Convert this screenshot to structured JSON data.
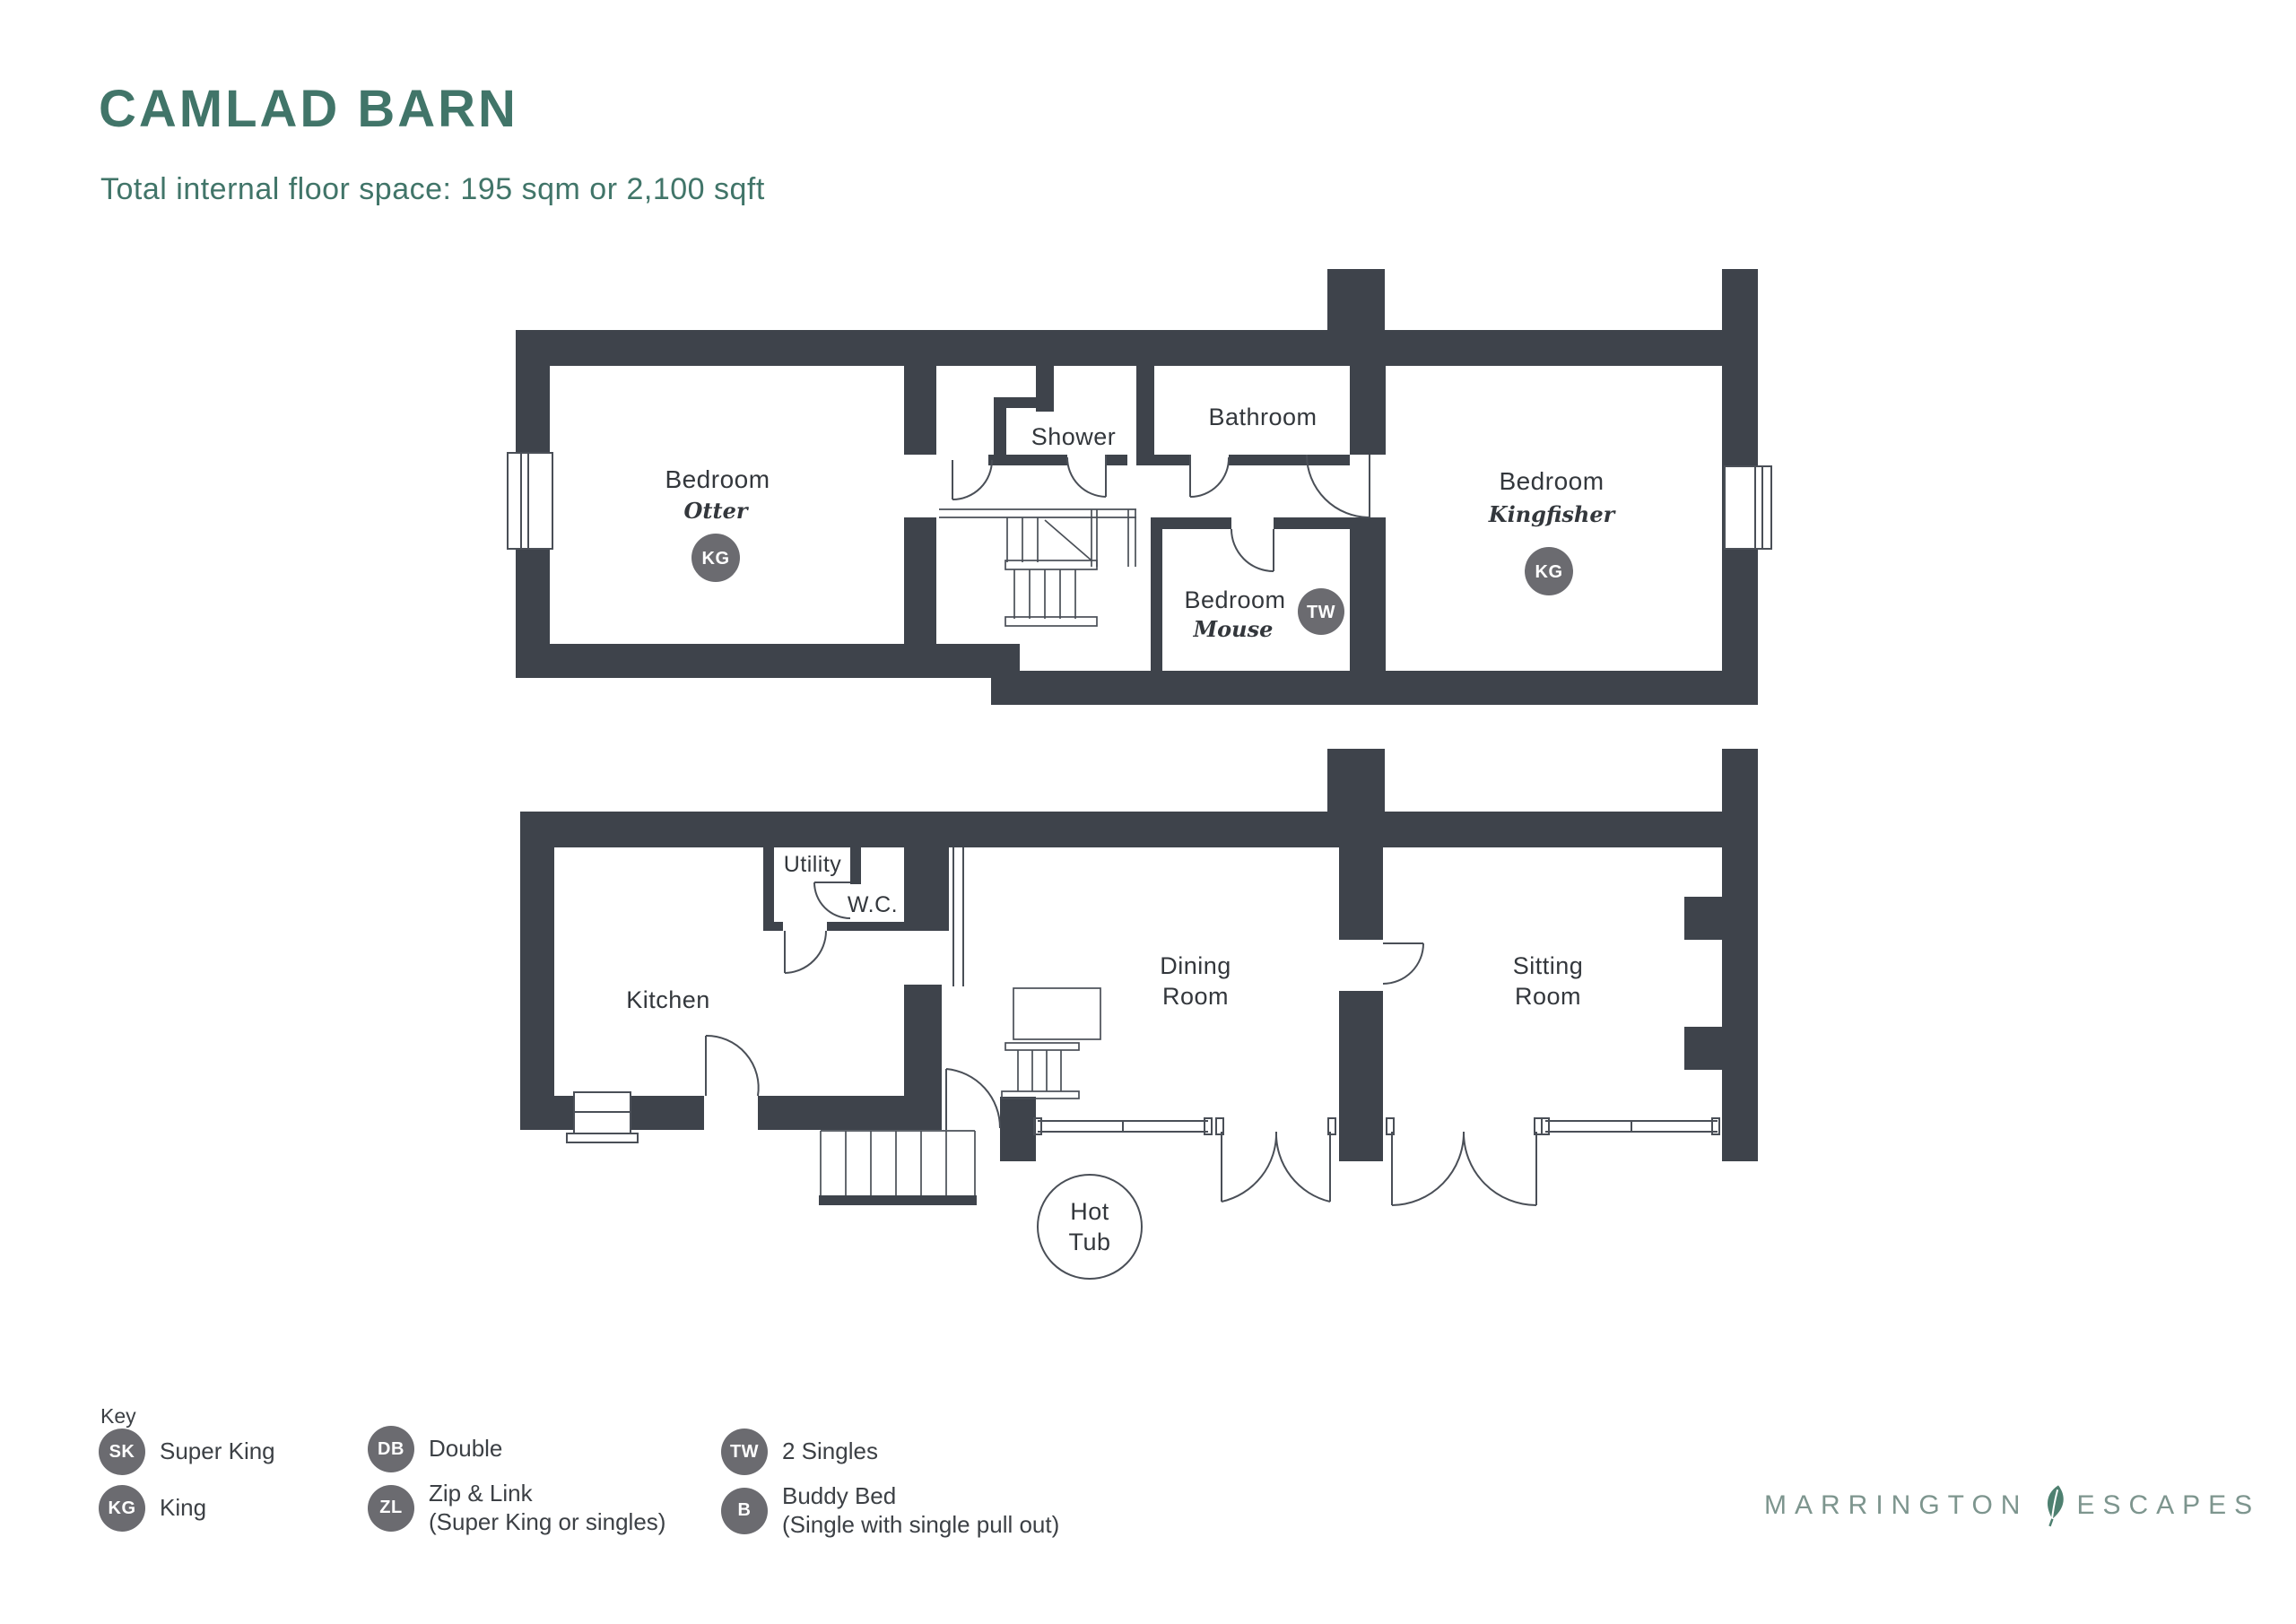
{
  "page": {
    "title": "CAMLAD BARN",
    "subtitle": "Total internal floor space: 195 sqm or 2,100 sqft"
  },
  "colors": {
    "accent": "#417569",
    "wall": "#3e434b",
    "thin_line": "#4a4f57",
    "badge": "#6b6b70",
    "label_text": "#33373c",
    "logo_text": "#7d958e",
    "leaf": "#4e8070"
  },
  "first_floor": {
    "bedroom_otter": {
      "label": "Bedroom",
      "name": "Otter",
      "badge": "KG"
    },
    "shower": {
      "label": "Shower"
    },
    "bathroom": {
      "label": "Bathroom"
    },
    "bedroom_mouse": {
      "label": "Bedroom",
      "name": "Mouse",
      "badge": "TW"
    },
    "bedroom_kingfisher": {
      "label": "Bedroom",
      "name": "Kingfisher",
      "badge": "KG"
    }
  },
  "ground_floor": {
    "kitchen": {
      "label": "Kitchen"
    },
    "utility": {
      "label": "Utility"
    },
    "wc": {
      "label": "W.C."
    },
    "dining": {
      "line1": "Dining",
      "line2": "Room"
    },
    "sitting": {
      "line1": "Sitting",
      "line2": "Room"
    },
    "hot_tub": {
      "line1": "Hot",
      "line2": "Tub"
    }
  },
  "key": {
    "label": "Key",
    "items": [
      {
        "badge": "SK",
        "label": "Super King",
        "sublabel": ""
      },
      {
        "badge": "KG",
        "label": "King",
        "sublabel": ""
      },
      {
        "badge": "DB",
        "label": "Double",
        "sublabel": ""
      },
      {
        "badge": "ZL",
        "label": "Zip & Link",
        "sublabel": "(Super King or singles)"
      },
      {
        "badge": "TW",
        "label": "2 Singles",
        "sublabel": ""
      },
      {
        "badge": "B",
        "label": "Buddy Bed",
        "sublabel": "(Single with single pull out)"
      }
    ]
  },
  "logo": {
    "part1": "MARRINGTON",
    "part2": "ESCAPES"
  }
}
